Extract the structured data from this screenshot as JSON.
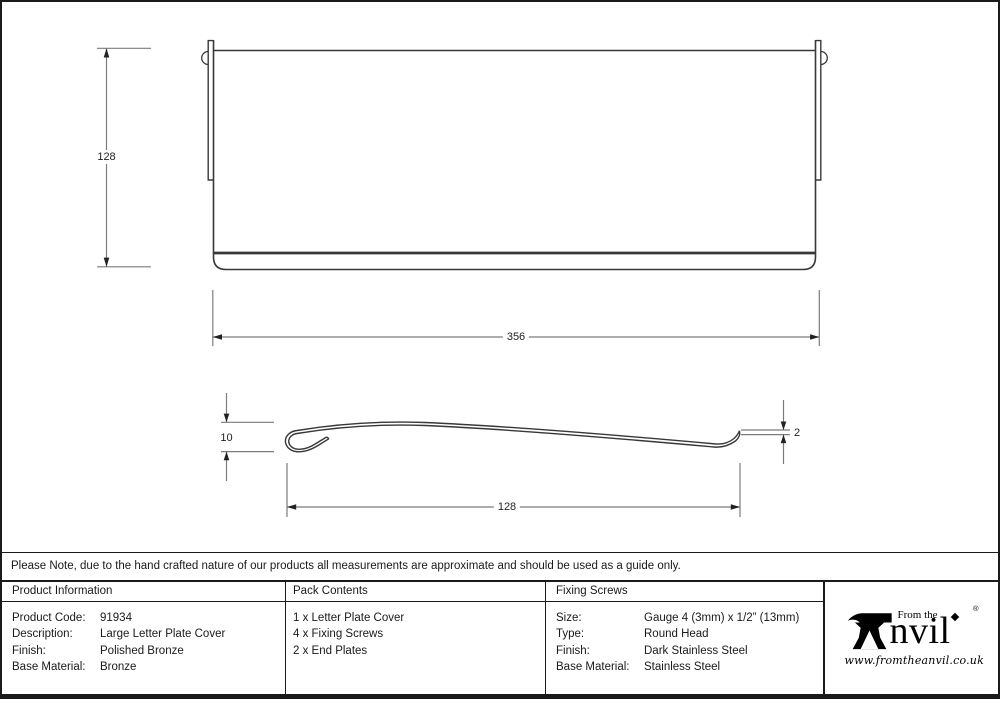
{
  "colors": {
    "outline": "#383838",
    "dim_line": "#7c7c7c",
    "table_border": "#1a1a1a",
    "text": "#1c1c1c"
  },
  "drawing": {
    "front_view": {
      "height_label": "128",
      "width_label": "356"
    },
    "profile_view": {
      "projection_label": "10",
      "thickness_label": "2",
      "flap_width_label": "128"
    }
  },
  "note": "Please Note, due to the hand crafted nature of our products all measurements are approximate and should be used as a guide only.",
  "table": {
    "product_information": {
      "header": "Product Information",
      "rows": [
        {
          "label": "Product Code:",
          "value": "91934"
        },
        {
          "label": "Description:",
          "value": "Large Letter Plate Cover"
        },
        {
          "label": "Finish:",
          "value": "Polished Bronze"
        },
        {
          "label": "Base Material:",
          "value": "Bronze"
        }
      ]
    },
    "pack_contents": {
      "header": "Pack Contents",
      "items": [
        "1 x Letter Plate Cover",
        "4 x Fixing Screws",
        "2 x End Plates"
      ]
    },
    "fixing_screws": {
      "header": "Fixing Screws",
      "rows": [
        {
          "label": "Size:",
          "value": "Gauge 4 (3mm) x 1/2” (13mm)"
        },
        {
          "label": "Type:",
          "value": "Round Head"
        },
        {
          "label": "Finish:",
          "value": "Dark Stainless Steel"
        },
        {
          "label": "Base Material:",
          "value": "Stainless Steel"
        }
      ]
    }
  },
  "logo": {
    "prefix": "From the",
    "name_suffix": "nvil",
    "registered_mark": "®",
    "website": "www.fromtheanvil.co.uk"
  }
}
